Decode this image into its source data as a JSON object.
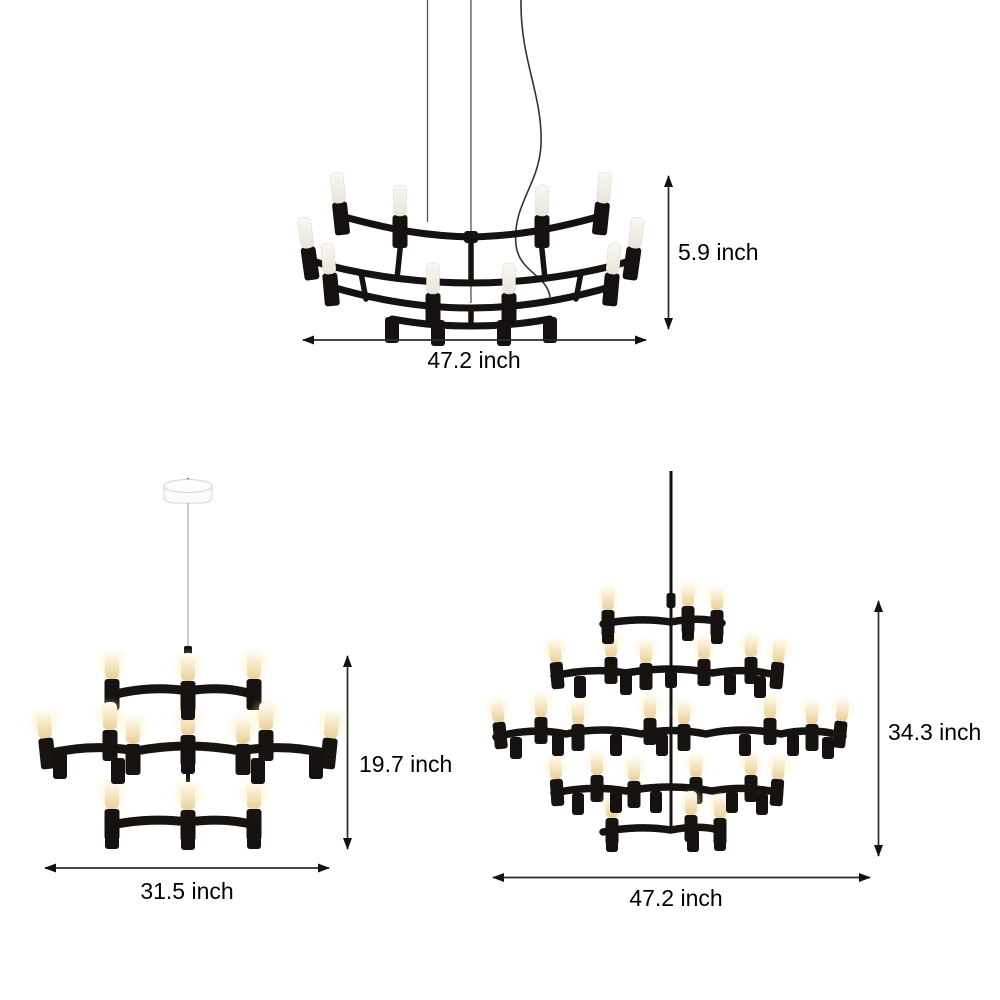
{
  "figure": {
    "background": "#ffffff",
    "unit": "inch",
    "products": [
      {
        "name": "flat-crown-chandelier",
        "height": "5.9 inch",
        "width": "47.2 inch"
      },
      {
        "name": "three-tier-crown-chandelier",
        "height": "19.7 inch",
        "width": "31.5 inch"
      },
      {
        "name": "five-tier-crown-chandelier",
        "height": "34.3 inch",
        "width": "47.2 inch"
      }
    ],
    "colors": {
      "frame_black": "#17120e",
      "bulb_unlit": "#f2efe7",
      "bulb_lit": "#f6e7c4",
      "dimension_line": "#2b2b2b",
      "label_text": "#000000",
      "wire_gray": "#9a9a9a",
      "canopy_white": "#fbfbfa"
    }
  }
}
